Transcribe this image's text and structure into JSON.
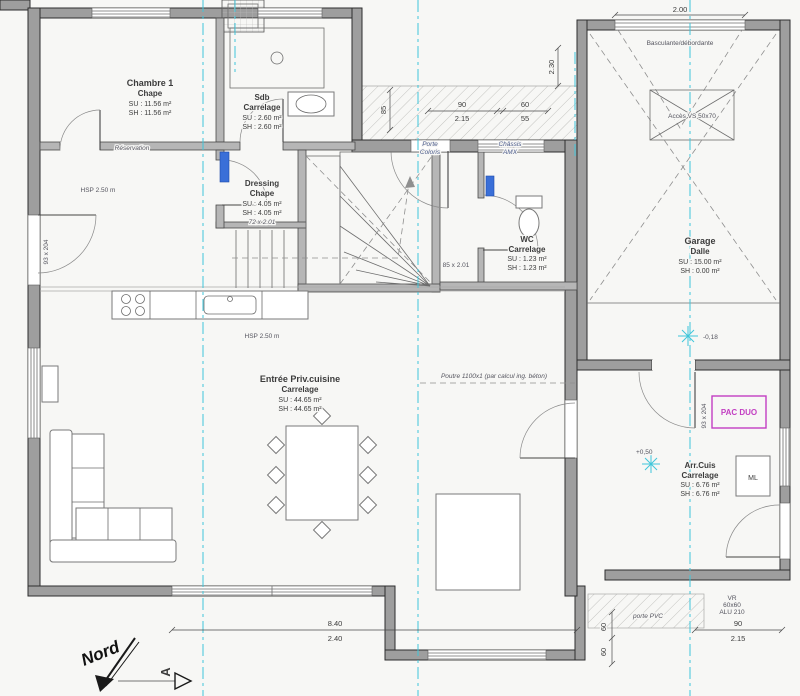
{
  "colors": {
    "paper": "#f7f7f5",
    "wall": "#9e9e9e",
    "axis": "#3fc6da",
    "pac_magenta": "#c23ec2",
    "fixture_blue": "#3a6fd8"
  },
  "rooms": {
    "chambre1": {
      "name": "Chambre 1",
      "finish": "Chape",
      "su": "SU : 11.56 m²",
      "sh": "SH : 11.56 m²"
    },
    "sdb": {
      "name": "Sdb",
      "finish": "Carrelage",
      "su": "SU : 2.60 m²",
      "sh": "SH : 2.60 m²"
    },
    "dressing": {
      "name": "Dressing",
      "finish": "Chape",
      "su": "SU : 4.05 m²",
      "sh": "SH : 4.05 m²",
      "door": "72 x 2.01"
    },
    "wc": {
      "name": "WC",
      "finish": "Carrelage",
      "su": "SU : 1.23 m²",
      "sh": "SH : 1.23 m²"
    },
    "garage": {
      "name": "Garage",
      "finish": "Dalle",
      "su": "SU : 15.00 m²",
      "sh": "SH : 0.00 m²"
    },
    "cuisine": {
      "name": "Entrée Priv.cuisine",
      "finish": "Carrelage",
      "su": "SU : 44.65 m²",
      "sh": "SH : 44.65 m²"
    },
    "arrcuis": {
      "name": "Arr.Cuis",
      "finish": "Carrelage",
      "su": "SU : 6.76 m²",
      "sh": "SH : 6.76 m²"
    }
  },
  "labels": {
    "nord": "Nord",
    "section": "A",
    "hsp_upper": "HSP 2.50 m",
    "hsp_sejour": "HSP 2.50 m",
    "reservation": "Réservation",
    "beam_note": "Poutre 1100x1 (par calcul ing. béton)",
    "pac": "PAC DUO",
    "ml": "ML",
    "acces_vs": "Accès VS 50x70",
    "garage_door": "Basculante/débordante",
    "porte_pvc": "porte PVC",
    "level_garage": "-0,18",
    "level_arrcuis": "+0,50",
    "door_left": "93 x 204",
    "door_pac": "93 x 204",
    "door_wc": "85 x 2.01",
    "entry_door_1": "Porte",
    "entry_door_2": "Coloris",
    "entry_win_1": "Châssis",
    "entry_win_2": "AMX",
    "vr_1": "VR",
    "vr_2": "60x60",
    "vr_3": "ALU 210"
  },
  "dims": {
    "entry_w": "90",
    "entry_h": "2.15",
    "win_w": "60",
    "win_h": "55",
    "porch_left": "85",
    "porch_right": "2.30",
    "garage_w": "2.00",
    "south_w": "8.40",
    "south_h": "2.40",
    "back_w": "90",
    "back_h": "2.15",
    "back_v1": "60",
    "back_v2": "60"
  }
}
